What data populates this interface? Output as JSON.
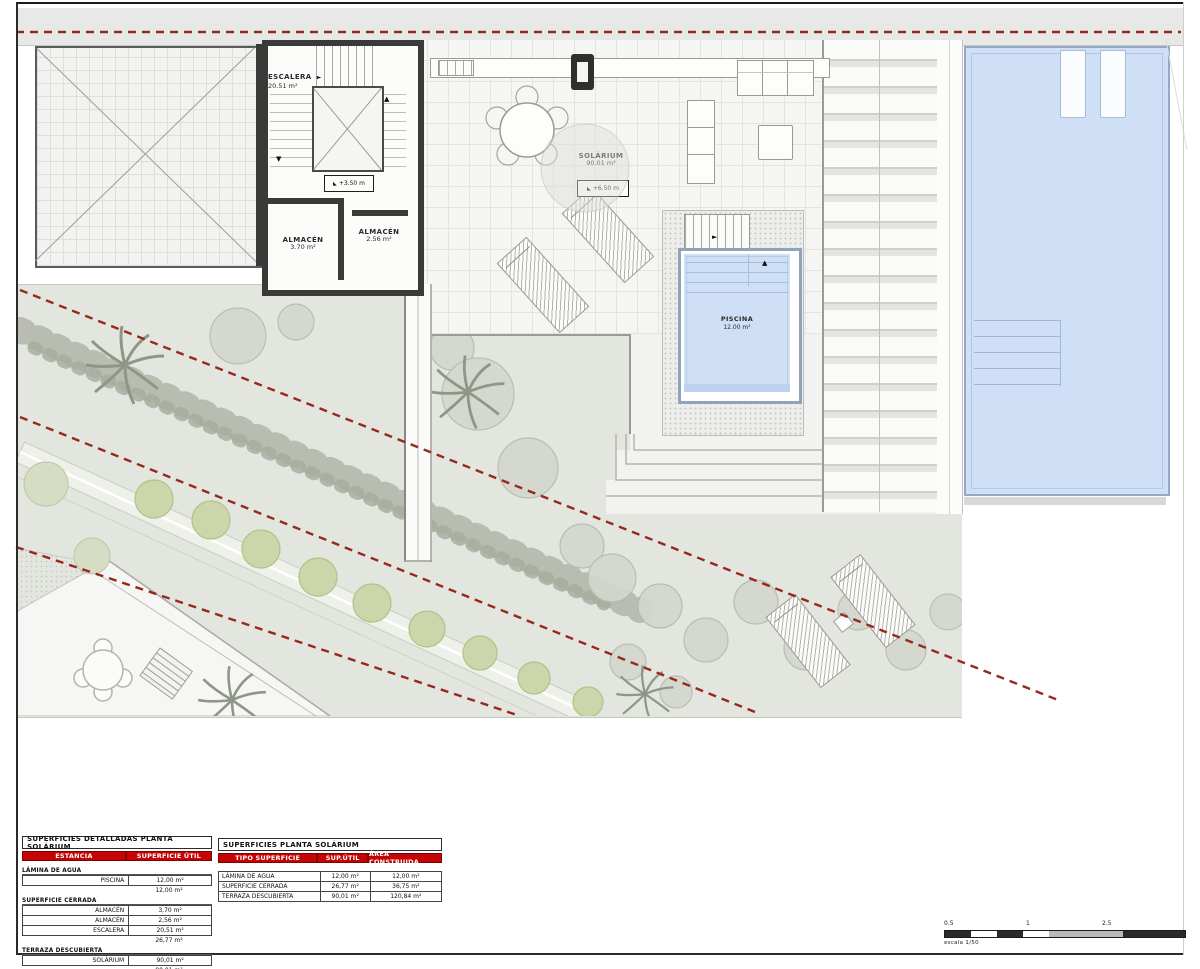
{
  "plan": {
    "rooms": {
      "escalera": {
        "name": "ESCALERA",
        "area": "20.51 m²"
      },
      "almacen_a": {
        "name": "ALMACÉN",
        "area": "3.70 m²"
      },
      "almacen_b": {
        "name": "ALMACÉN",
        "area": "2.56 m²"
      },
      "solarium": {
        "name": "SOLÁRIUM",
        "area": "90.01 m²"
      },
      "piscina": {
        "name": "PISCINA",
        "area": "12.00 m²"
      }
    },
    "level_markers": {
      "stair": "+3.50 m",
      "solarium": "+6.50 m"
    },
    "icons": {
      "right_arrow": "►",
      "up_arrow": "▲",
      "down_arrow": "▼",
      "level": "◣"
    }
  },
  "tables": {
    "detailed": {
      "title": "SUPERFICIES DETALLADAS PLANTA SOLÁRIUM",
      "headers": [
        "ESTANCIA",
        "SUPERFICIE ÚTIL"
      ],
      "sections": [
        {
          "label": "LÁMINA DE AGUA",
          "rows": [
            [
              "PISCINA",
              "12,00 m²"
            ]
          ],
          "subtotal": "12,00 m²"
        },
        {
          "label": "SUPERFICIE CERRADA",
          "rows": [
            [
              "ALMACÉN",
              "3,70 m²"
            ],
            [
              "ALMACÉN",
              "2,56 m²"
            ],
            [
              "ESCALERA",
              "20,51 m²"
            ]
          ],
          "subtotal": "26,77 m²"
        },
        {
          "label": "TERRAZA DESCUBIERTA",
          "rows": [
            [
              "SOLÁRIUM",
              "90,01 m²"
            ]
          ],
          "subtotal": "90,01 m²"
        }
      ]
    },
    "summary": {
      "title": "SUPERFICIES PLANTA SOLÁRIUM",
      "headers": [
        "TIPO SUPERFICIE",
        "SUP.ÚTIL",
        "ÁREA CONSTRUIDA"
      ],
      "rows": [
        [
          "LÁMINA DE AGUA",
          "12,00 m²",
          "12,00 m²"
        ],
        [
          "SUPERFICIE CERRADA",
          "26,77 m²",
          "36,75 m²"
        ],
        [
          "TERRAZA DESCUBIERTA",
          "90,01 m²",
          "120,84 m²"
        ]
      ]
    }
  },
  "scalebar": {
    "labels": [
      "0.5",
      "1",
      "2.5"
    ],
    "caption": "escala 1/50"
  },
  "colors": {
    "accent_red": "#c40404",
    "dashed_line": "#96291f",
    "pool_water": "#cfe0f6",
    "garden": "#e3e6de",
    "wall_dark": "#3a3a38"
  }
}
